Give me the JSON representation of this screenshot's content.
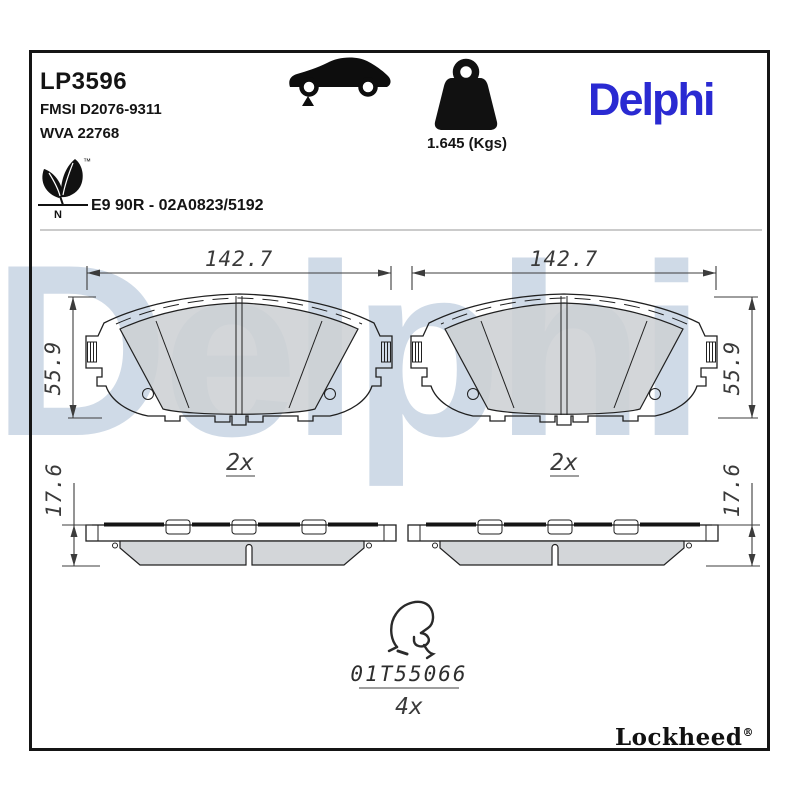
{
  "header": {
    "part_number": "LP3596",
    "fmsi_code": "FMSI D2076-9311",
    "wva_code": "WVA 22768",
    "homologation": "E9 90R - 02A0823/5192",
    "weight": "1.645 (Kgs)",
    "brand": "Delphi",
    "brand_color": "#2a2ad2",
    "eco_mark_letter": "N",
    "trademark_symbol": "™"
  },
  "watermark_text": "Delphi",
  "views": {
    "front_left": {
      "width_mm": "142.7",
      "height_mm": "55.9",
      "quantity": "2x"
    },
    "front_right": {
      "width_mm": "142.7",
      "height_mm": "55.9",
      "quantity": "2x"
    },
    "side_left": {
      "thickness_mm": "17.6"
    },
    "side_right": {
      "thickness_mm": "17.6"
    }
  },
  "accessory": {
    "part_code": "01T55066",
    "quantity": "4x"
  },
  "footer": {
    "brand": "Lockheed",
    "registered_symbol": "®"
  }
}
